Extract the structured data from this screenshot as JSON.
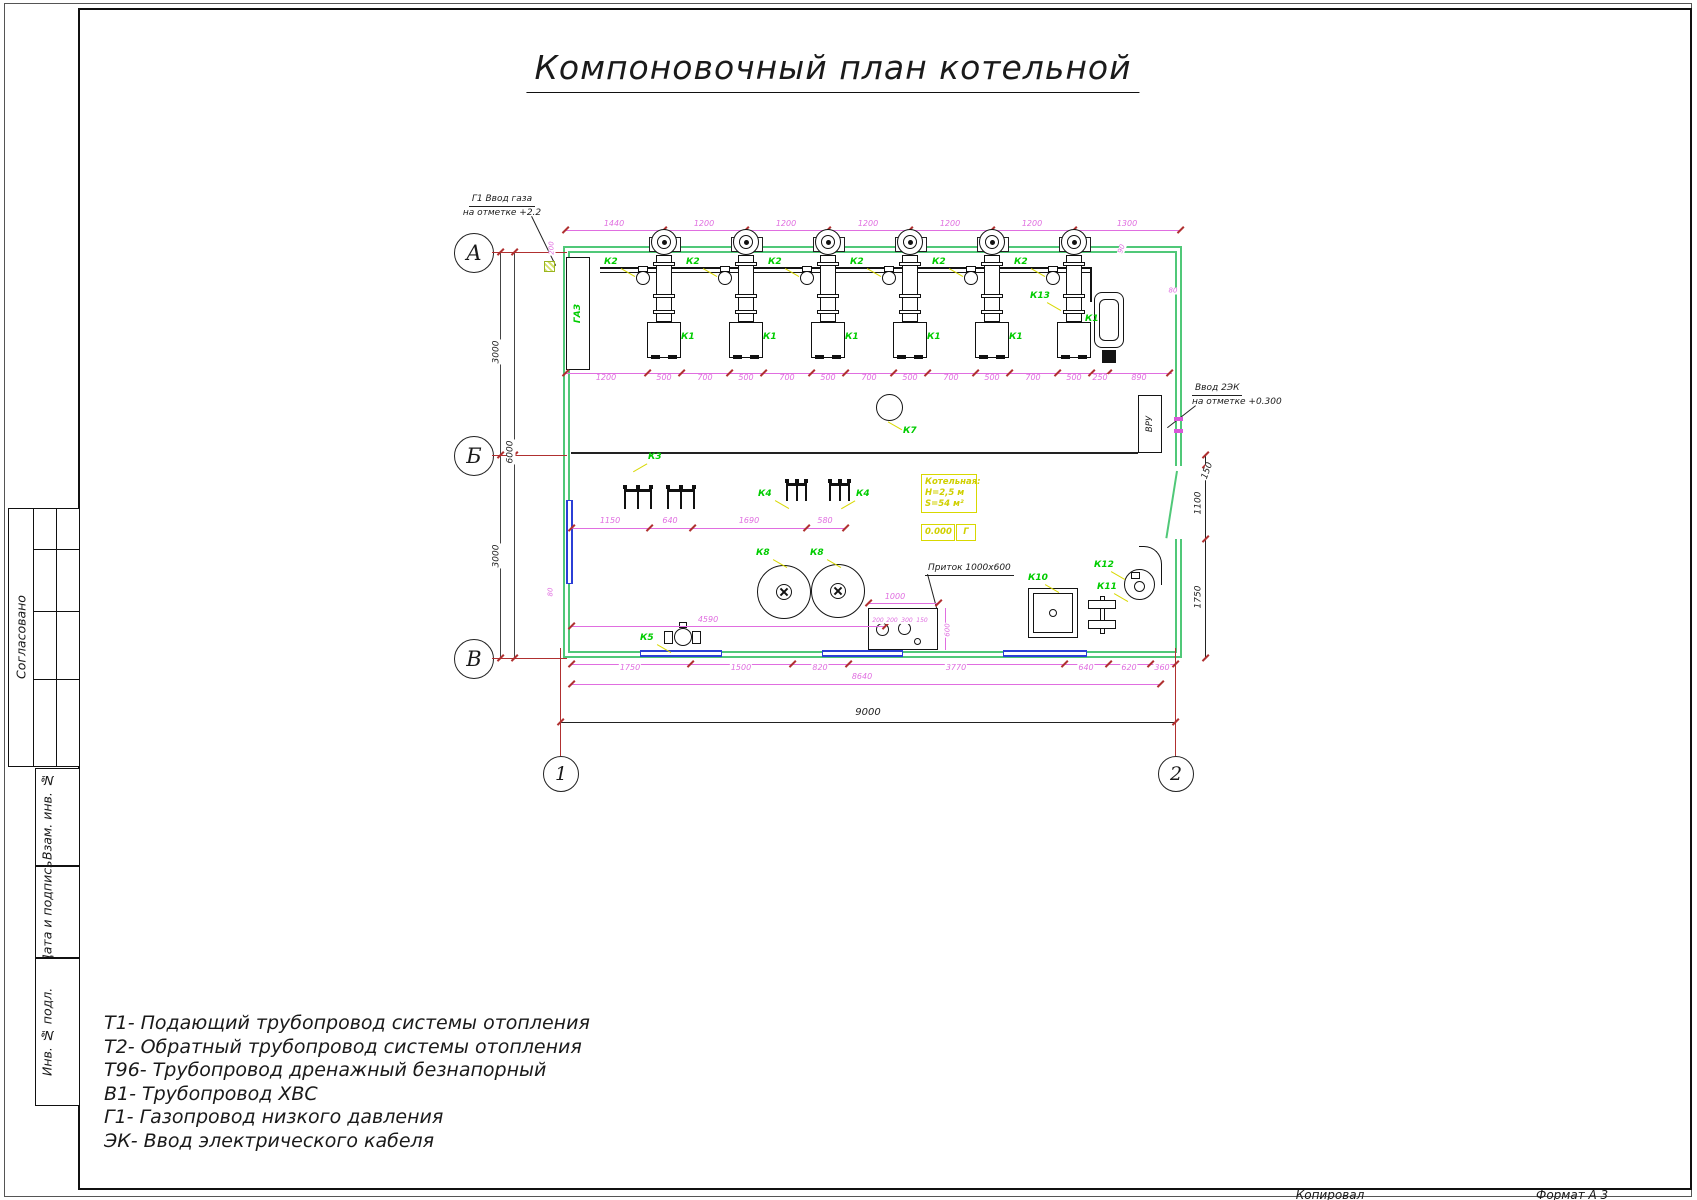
{
  "title": "Компоновочный план котельной",
  "stamp": {
    "soglasovano": "Согласовано",
    "vzam": "Взам. инв. №",
    "data_podpis": "Дата и подпись",
    "inv_podl": "Инв. № подл.",
    "kopiroval": "Копировал",
    "format": "Формат А 3"
  },
  "legend": [
    "Т1- Подающий трубопровод системы отопления",
    "Т2- Обратный трубопровод системы отопления",
    "Т96- Трубопровод дренажный безнапорный",
    "В1- Трубопровод ХВС",
    "Г1- Газопровод низкого давления",
    "ЭК- Ввод электрического кабеля"
  ],
  "axes": {
    "rows": [
      "А",
      "Б",
      "В"
    ],
    "cols": [
      "1",
      "2"
    ]
  },
  "annotations": {
    "gas_inlet": {
      "line1": "Г1 Ввод газа",
      "line2": "на отметке +2.2"
    },
    "cable_inlet": {
      "line1": "Ввод 2ЭК",
      "line2": "на отметке +0.300"
    },
    "pritok": "Приток 1000х600"
  },
  "room_info": {
    "title": "Котельная:",
    "height": "Н=2,5 м",
    "area": "S=54 м²",
    "level": "0.000",
    "room_letter": "Г"
  },
  "plan_texts": {
    "gaz": "ГАЗ",
    "vru": "ВРУ"
  },
  "colors": {
    "wall": "#50c878",
    "window": "#2b3fd6",
    "dim": "#e06ee0",
    "axis_red": "#b03030",
    "label_green": "#00cc00",
    "accent_yellow": "#d8d800",
    "line_black": "#1a1a1a"
  },
  "plan": {
    "boiler_centers": [
      664,
      746,
      828,
      910,
      992,
      1074
    ],
    "labels": [
      {
        "t": "К2",
        "x": 604,
        "y": 258,
        "ld": "br"
      },
      {
        "t": "К2",
        "x": 686,
        "y": 258,
        "ld": "br"
      },
      {
        "t": "К2",
        "x": 768,
        "y": 258,
        "ld": "br"
      },
      {
        "t": "К2",
        "x": 850,
        "y": 258,
        "ld": "br"
      },
      {
        "t": "К2",
        "x": 932,
        "y": 258,
        "ld": "br"
      },
      {
        "t": "К2",
        "x": 1014,
        "y": 258,
        "ld": "br"
      },
      {
        "t": "К1",
        "x": 681,
        "y": 333,
        "ld": "bl"
      },
      {
        "t": "К1",
        "x": 763,
        "y": 333,
        "ld": "bl"
      },
      {
        "t": "К1",
        "x": 845,
        "y": 333,
        "ld": "bl"
      },
      {
        "t": "К1",
        "x": 927,
        "y": 333,
        "ld": "bl"
      },
      {
        "t": "К1",
        "x": 1009,
        "y": 333,
        "ld": "bl"
      },
      {
        "t": "К1",
        "x": 1085,
        "y": 315,
        "ld": "bl"
      },
      {
        "t": "К3",
        "x": 648,
        "y": 453,
        "ld": "bl"
      },
      {
        "t": "К4",
        "x": 758,
        "y": 490,
        "ld": "br"
      },
      {
        "t": "К4",
        "x": 856,
        "y": 490,
        "ld": "bl"
      },
      {
        "t": "К7",
        "x": 903,
        "y": 427,
        "ld": "tl"
      },
      {
        "t": "К8",
        "x": 756,
        "y": 549,
        "ld": "br"
      },
      {
        "t": "К8",
        "x": 810,
        "y": 549,
        "ld": "br"
      },
      {
        "t": "К5",
        "x": 640,
        "y": 634,
        "ld": "br"
      },
      {
        "t": "К10",
        "x": 1028,
        "y": 574,
        "ld": "br"
      },
      {
        "t": "К11",
        "x": 1097,
        "y": 583,
        "ld": "br"
      },
      {
        "t": "К12",
        "x": 1094,
        "y": 561,
        "ld": "br"
      },
      {
        "t": "К13",
        "x": 1030,
        "y": 292,
        "ld": "br"
      }
    ],
    "dim_texts": [
      {
        "t": "1440",
        "x": 614,
        "y": 224
      },
      {
        "t": "1200",
        "x": 704,
        "y": 224
      },
      {
        "t": "1200",
        "x": 786,
        "y": 224
      },
      {
        "t": "1200",
        "x": 868,
        "y": 224
      },
      {
        "t": "1200",
        "x": 950,
        "y": 224
      },
      {
        "t": "1200",
        "x": 1032,
        "y": 224
      },
      {
        "t": "1300",
        "x": 1127,
        "y": 224
      },
      {
        "t": "1200",
        "x": 606,
        "y": 378
      },
      {
        "t": "500",
        "x": 664,
        "y": 378
      },
      {
        "t": "700",
        "x": 705,
        "y": 378
      },
      {
        "t": "500",
        "x": 746,
        "y": 378
      },
      {
        "t": "700",
        "x": 787,
        "y": 378
      },
      {
        "t": "500",
        "x": 828,
        "y": 378
      },
      {
        "t": "700",
        "x": 869,
        "y": 378
      },
      {
        "t": "500",
        "x": 910,
        "y": 378
      },
      {
        "t": "700",
        "x": 951,
        "y": 378
      },
      {
        "t": "500",
        "x": 992,
        "y": 378
      },
      {
        "t": "700",
        "x": 1033,
        "y": 378
      },
      {
        "t": "500",
        "x": 1074,
        "y": 378
      },
      {
        "t": "250",
        "x": 1100,
        "y": 378
      },
      {
        "t": "890",
        "x": 1139,
        "y": 378
      },
      {
        "t": "1150",
        "x": 610,
        "y": 521
      },
      {
        "t": "640",
        "x": 670,
        "y": 521
      },
      {
        "t": "1690",
        "x": 749,
        "y": 521
      },
      {
        "t": "580",
        "x": 825,
        "y": 521
      },
      {
        "t": "1000",
        "x": 895,
        "y": 597
      },
      {
        "t": "4590",
        "x": 708,
        "y": 620
      },
      {
        "t": "1750",
        "x": 630,
        "y": 668
      },
      {
        "t": "1500",
        "x": 741,
        "y": 668
      },
      {
        "t": "820",
        "x": 820,
        "y": 668
      },
      {
        "t": "3770",
        "x": 956,
        "y": 668
      },
      {
        "t": "640",
        "x": 1086,
        "y": 668
      },
      {
        "t": "620",
        "x": 1129,
        "y": 668
      },
      {
        "t": "360",
        "x": 1162,
        "y": 668
      },
      {
        "t": "8640",
        "x": 862,
        "y": 677
      },
      {
        "t": "9000",
        "x": 868,
        "y": 713,
        "c": "#222",
        "s": 10
      },
      {
        "t": "150",
        "x": 1208,
        "y": 471,
        "r": -70,
        "c": "#222",
        "s": 9
      },
      {
        "t": "1100",
        "x": 1199,
        "y": 503,
        "r": -90,
        "c": "#222",
        "s": 9
      },
      {
        "t": "1750",
        "x": 1199,
        "y": 597,
        "r": -90,
        "c": "#222",
        "s": 9
      },
      {
        "t": "3000",
        "x": 497,
        "y": 352,
        "r": -90,
        "c": "#222",
        "s": 9
      },
      {
        "t": "6000",
        "x": 511,
        "y": 452,
        "r": -90,
        "c": "#222",
        "s": 9
      },
      {
        "t": "3000",
        "x": 497,
        "y": 556,
        "r": -90,
        "c": "#222",
        "s": 9
      },
      {
        "t": "200",
        "x": 552,
        "y": 248,
        "r": -90,
        "s": 7
      },
      {
        "t": "90",
        "x": 1122,
        "y": 249,
        "r": -70,
        "s": 7
      },
      {
        "t": "80",
        "x": 1173,
        "y": 291,
        "s": 7
      },
      {
        "t": "80",
        "x": 551,
        "y": 592,
        "r": -90,
        "s": 7
      },
      {
        "t": "600",
        "x": 948,
        "y": 630,
        "r": -90,
        "s": 7
      },
      {
        "t": "200",
        "x": 878,
        "y": 621,
        "s": 6
      },
      {
        "t": "200",
        "x": 892,
        "y": 621,
        "s": 6
      },
      {
        "t": "300",
        "x": 907,
        "y": 621,
        "s": 6
      },
      {
        "t": "150",
        "x": 922,
        "y": 621,
        "s": 6
      }
    ],
    "dim_lines": [
      {
        "x1": 565,
        "x2": 1180,
        "y": 230,
        "ticks": [
          565,
          663,
          745,
          827,
          909,
          991,
          1073,
          1180
        ]
      },
      {
        "x1": 565,
        "x2": 1172,
        "y": 373,
        "ticks": [
          565,
          647,
          681,
          729,
          763,
          811,
          845,
          893,
          927,
          975,
          1009,
          1057,
          1091,
          1108,
          1169
        ]
      },
      {
        "x1": 571,
        "x2": 845,
        "y": 528,
        "ticks": [
          571,
          649,
          692,
          806,
          845
        ]
      },
      {
        "x1": 868,
        "x2": 938,
        "y": 603,
        "ticks": [
          868,
          938
        ]
      },
      {
        "x1": 571,
        "x2": 885,
        "y": 626,
        "ticks": [
          571,
          885
        ]
      },
      {
        "x1": 571,
        "x2": 1175,
        "y": 664,
        "ticks": [
          571,
          690,
          792,
          848,
          1064,
          1108,
          1150,
          1175
        ]
      },
      {
        "x1": 571,
        "x2": 1160,
        "y": 684,
        "ticks": [
          571,
          1160
        ]
      },
      {
        "x1": 560,
        "x2": 1175,
        "y": 722,
        "c": "#222",
        "ticks": [
          560,
          1175
        ]
      },
      {
        "v": 1,
        "x": 1205,
        "y1": 455,
        "y2": 658,
        "c": "#222",
        "ticks": [
          455,
          465,
          539,
          658
        ]
      },
      {
        "v": 1,
        "x": 945,
        "y1": 608,
        "y2": 650,
        "ticks": []
      },
      {
        "v": 1,
        "x": 500,
        "y1": 252,
        "y2": 658,
        "c": "#444",
        "ticks": [
          252,
          455,
          658
        ]
      },
      {
        "v": 1,
        "x": 514,
        "y1": 252,
        "y2": 658,
        "c": "#444",
        "ticks": [
          252,
          455,
          658
        ]
      }
    ],
    "red_lines": [
      {
        "x1": 492,
        "y1": 252,
        "x2": 567,
        "y2": 252
      },
      {
        "x1": 492,
        "y1": 455,
        "x2": 567,
        "y2": 455
      },
      {
        "x1": 492,
        "y1": 658,
        "x2": 567,
        "y2": 658
      },
      {
        "x1": 560,
        "y1": 648,
        "x2": 560,
        "y2": 756
      },
      {
        "x1": 1175,
        "y1": 648,
        "x2": 1175,
        "y2": 756
      }
    ],
    "combs": [
      {
        "x": 624,
        "y": 489,
        "w": 28,
        "h": 20,
        "n": 3
      },
      {
        "x": 667,
        "y": 489,
        "w": 28,
        "h": 20,
        "n": 3
      },
      {
        "x": 786,
        "y": 483,
        "w": 21,
        "h": 18,
        "n": 3
      },
      {
        "x": 829,
        "y": 483,
        "w": 21,
        "h": 18,
        "n": 3
      }
    ]
  }
}
